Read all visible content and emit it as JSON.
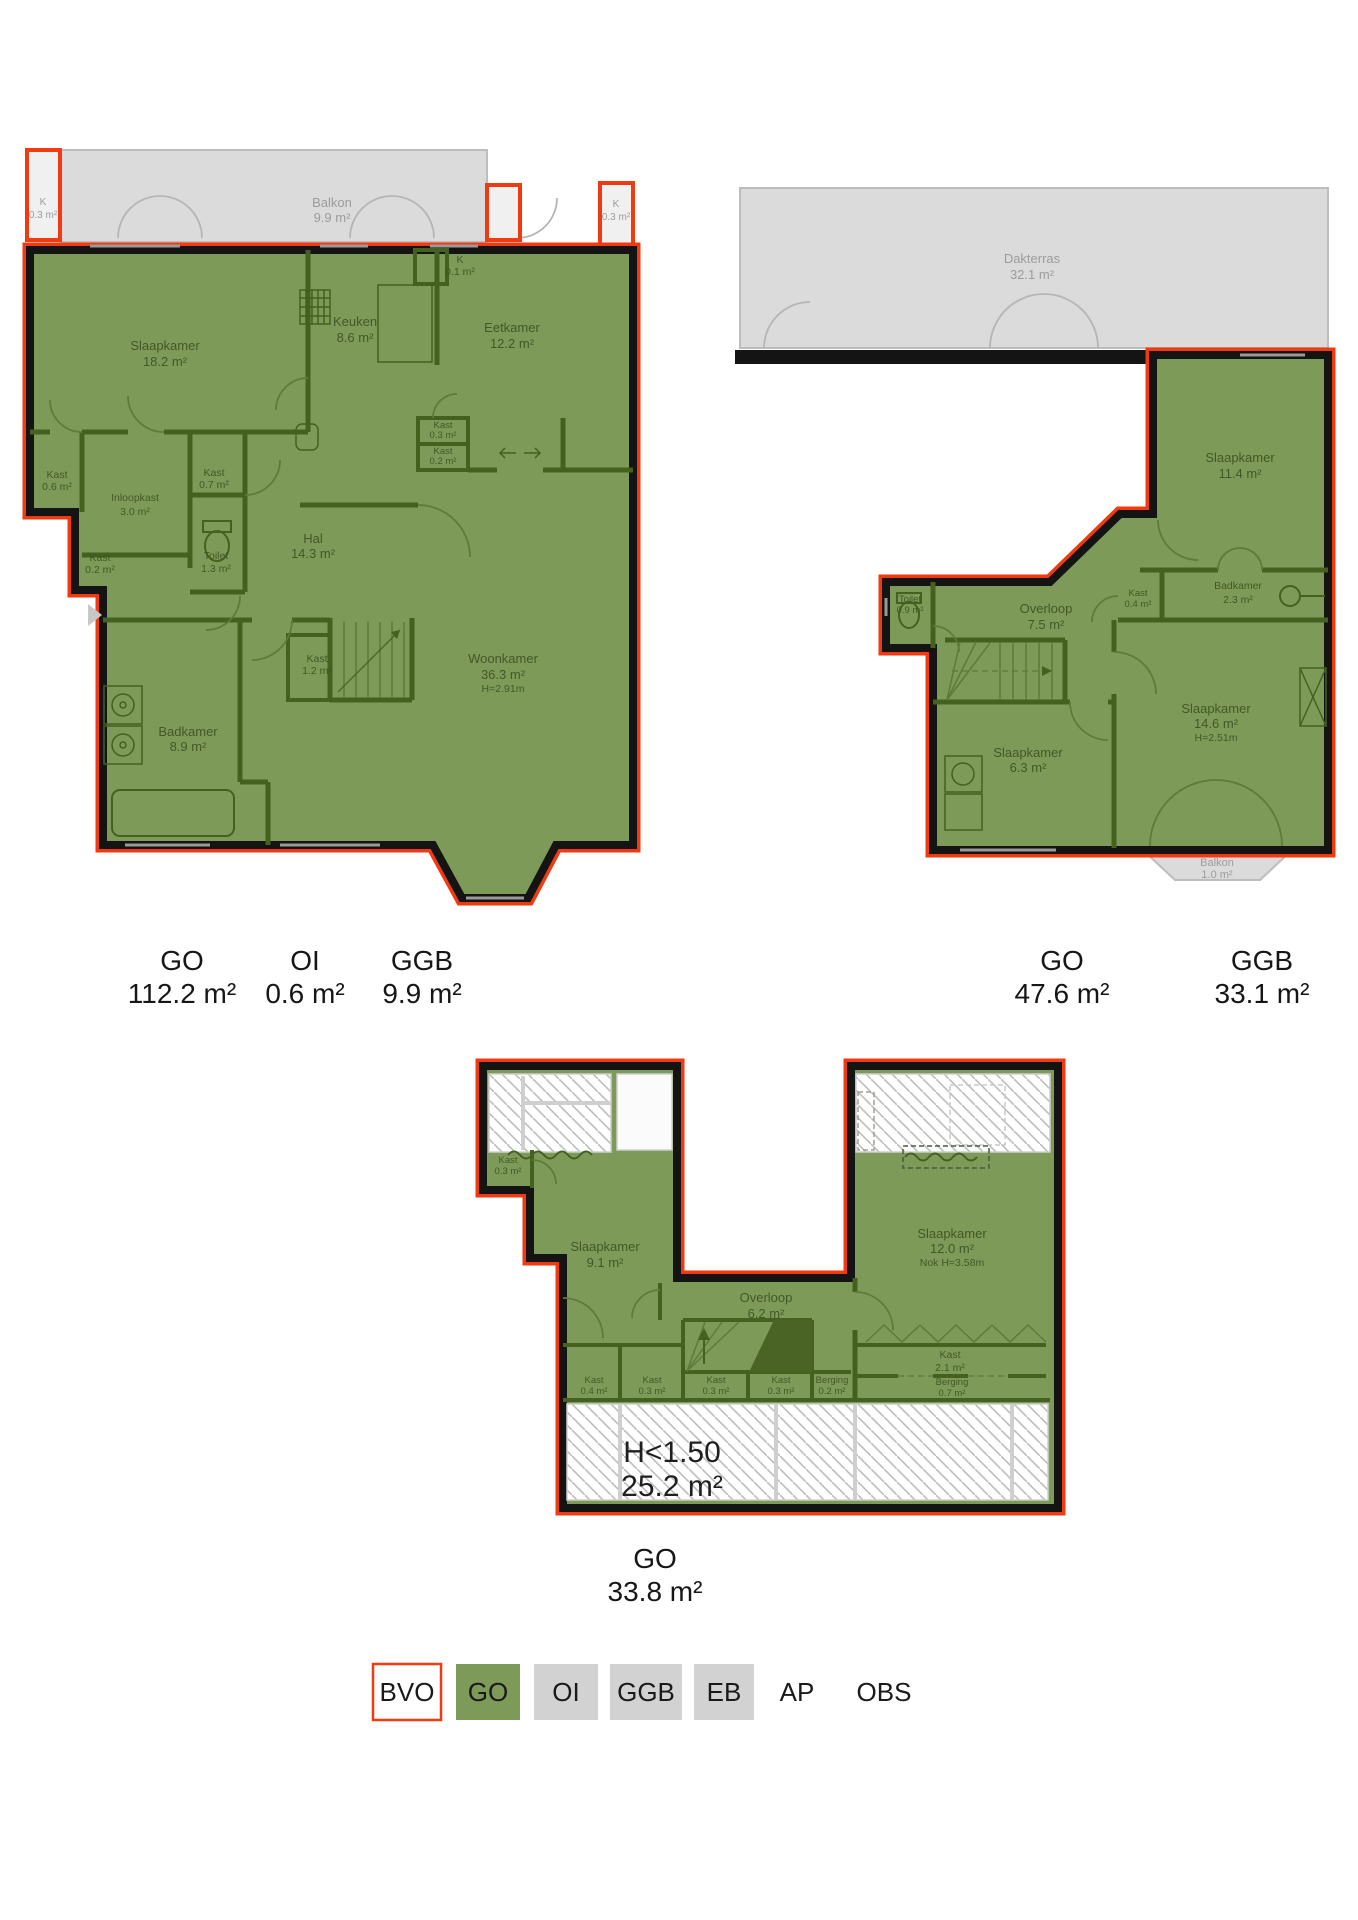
{
  "plan1": {
    "balkon": {
      "name": "Balkon",
      "area": "9.9 m²"
    },
    "k_left": {
      "name": "K",
      "area": "0.3 m²"
    },
    "k_right": {
      "name": "K",
      "area": "0.3 m²"
    },
    "slaapkamer": {
      "name": "Slaapkamer",
      "area": "18.2 m²"
    },
    "keuken": {
      "name": "Keuken",
      "area": "8.6 m²"
    },
    "k_niche": {
      "name": "K",
      "area": "0.1 m²"
    },
    "eetkamer": {
      "name": "Eetkamer",
      "area": "12.2 m²"
    },
    "kast_a": {
      "name": "Kast",
      "area": "0.3 m²"
    },
    "kast_b": {
      "name": "Kast",
      "area": "0.2 m²"
    },
    "kast_06": {
      "name": "Kast",
      "area": "0.6 m²"
    },
    "inloopkast": {
      "name": "Inloopkast",
      "area": "3.0 m²"
    },
    "kast_07": {
      "name": "Kast",
      "area": "0.7 m²"
    },
    "toilet": {
      "name": "Toilet",
      "area": "1.3 m²"
    },
    "hal": {
      "name": "Hal",
      "area": "14.3 m²"
    },
    "kast_02": {
      "name": "Kast",
      "area": "0.2 m²"
    },
    "kast_12": {
      "name": "Kast",
      "area": "1.2 m²"
    },
    "woonkamer": {
      "name": "Woonkamer",
      "area": "36.3 m²",
      "note": "H=2.91m"
    },
    "badkamer": {
      "name": "Badkamer",
      "area": "8.9 m²"
    }
  },
  "plan2": {
    "dakterras": {
      "name": "Dakterras",
      "area": "32.1 m²"
    },
    "slaapkamer_114": {
      "name": "Slaapkamer",
      "area": "11.4 m²"
    },
    "badkamer": {
      "name": "Badkamer",
      "area": "2.3 m²"
    },
    "kast_04": {
      "name": "Kast",
      "area": "0.4 m²"
    },
    "toilet": {
      "name": "Toilet",
      "area": "0.9 m²"
    },
    "overloop": {
      "name": "Overloop",
      "area": "7.5 m²"
    },
    "slaapkamer_63": {
      "name": "Slaapkamer",
      "area": "6.3 m²"
    },
    "slaapkamer_146": {
      "name": "Slaapkamer",
      "area": "14.6 m²",
      "note": "H=2.51m"
    },
    "balkon": {
      "name": "Balkon",
      "area": "1.0 m²"
    }
  },
  "plan3": {
    "kast_03_top": {
      "name": "Kast",
      "area": "0.3 m²"
    },
    "slaapkamer_91": {
      "name": "Slaapkamer",
      "area": "9.1 m²"
    },
    "overloop": {
      "name": "Overloop",
      "area": "6.2 m²"
    },
    "slaapkamer_120": {
      "name": "Slaapkamer",
      "area": "12.0 m²",
      "note": "Nok H=3.58m"
    },
    "kast_21": {
      "name": "Kast",
      "area": "2.1 m²"
    },
    "kast_04": {
      "name": "Kast",
      "area": "0.4 m²"
    },
    "kast_03_l": {
      "name": "Kast",
      "area": "0.3 m²"
    },
    "kast_03_a": {
      "name": "Kast",
      "area": "0.3 m²"
    },
    "kast_03_b": {
      "name": "Kast",
      "area": "0.3 m²"
    },
    "berging_02": {
      "name": "Berging",
      "area": "0.2 m²"
    },
    "berging_07": {
      "name": "Berging",
      "area": "0.7 m²"
    },
    "h150": {
      "line1": "H<1.50",
      "line2": "25.2 m²"
    }
  },
  "summaries": {
    "plan1": [
      {
        "code": "GO",
        "area": "112.2 m²"
      },
      {
        "code": "OI",
        "area": "0.6 m²"
      },
      {
        "code": "GGB",
        "area": "9.9 m²"
      }
    ],
    "plan2": [
      {
        "code": "GO",
        "area": "47.6 m²"
      },
      {
        "code": "GGB",
        "area": "33.1 m²"
      }
    ],
    "plan3": [
      {
        "code": "GO",
        "area": "33.8 m²"
      }
    ]
  },
  "legend": {
    "items": [
      {
        "code": "BVO",
        "style": "red-outline"
      },
      {
        "code": "GO",
        "style": "green"
      },
      {
        "code": "OI",
        "style": "gray"
      },
      {
        "code": "GGB",
        "style": "gray"
      },
      {
        "code": "EB",
        "style": "gray"
      },
      {
        "code": "AP",
        "style": "plain"
      },
      {
        "code": "OBS",
        "style": "plain"
      }
    ]
  },
  "colors": {
    "go_green": "#7E9A58",
    "outline_red": "#F03A12",
    "wall_black": "#141414",
    "terrace_gray": "#DBDBDB",
    "legend_gray": "#D2D2D2"
  }
}
